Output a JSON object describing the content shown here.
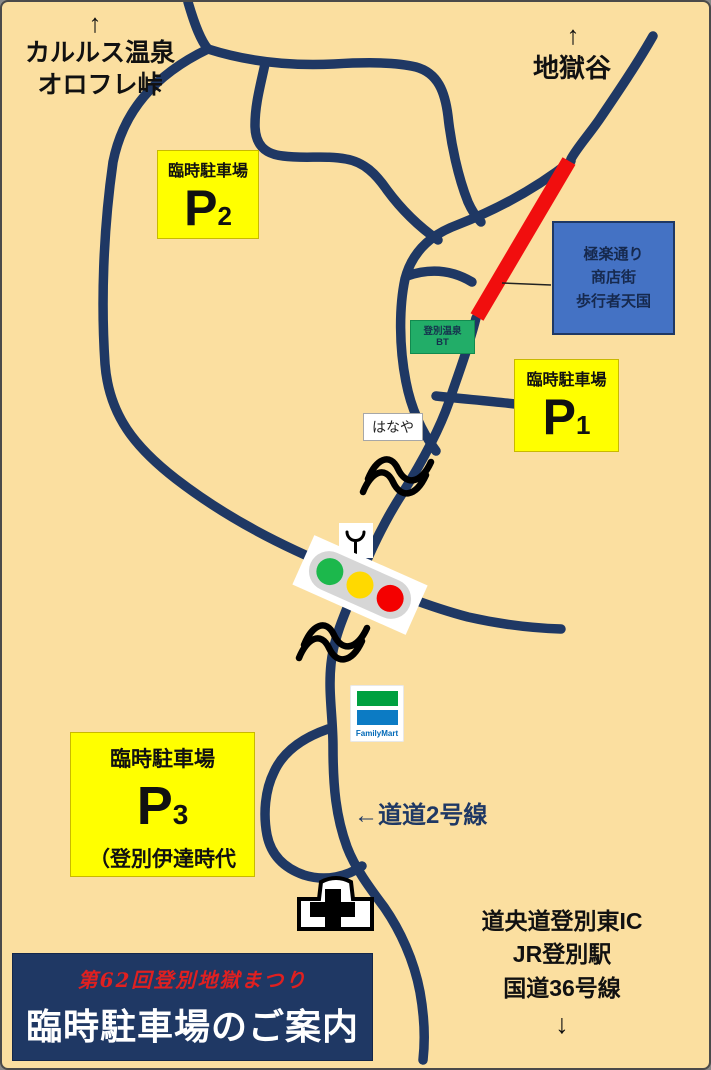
{
  "colors": {
    "background": "#FBDFA0",
    "road": "#1F3864",
    "pedestrian_red": "#F10E0E",
    "parking_yellow": "#FFFF00",
    "info_blue": "#4472C4",
    "bus_terminal_green": "#22AD68",
    "banner_navy": "#1F3864",
    "banner_red_text": "#E02020",
    "familymart_green": "#00A040",
    "familymart_blue": "#0C7BC4",
    "signal_green": "#1CB84C",
    "signal_yellow": "#FFD900",
    "signal_red": "#F40000"
  },
  "labels": {
    "top_left_arrow": "↑",
    "top_left_line1": "カルルス温泉",
    "top_left_line2": "オロフレ峠",
    "top_right_arrow": "↑",
    "top_right": "地獄谷",
    "road2": "←道道2号線",
    "south_line1": "道央道登別東IC",
    "south_line2": "JR登別駅",
    "south_line3": "国道36号線",
    "south_arrow": "↓"
  },
  "parking": {
    "p2": {
      "title": "臨時駐車場",
      "letter": "P",
      "number": "2"
    },
    "p1": {
      "title": "臨時駐車場",
      "letter": "P",
      "number": "1"
    },
    "p3": {
      "title": "臨時駐車場",
      "letter": "P",
      "number": "3",
      "note": "（登別伊達時代"
    }
  },
  "pedestrian_zone": {
    "line1": "極楽通り",
    "line2": "商店街",
    "line3": "歩行者天国"
  },
  "bus_terminal": {
    "line1": "登別温泉",
    "line2": "BT"
  },
  "shops": {
    "hanaya": "はなや",
    "familymart": "FamilyMart"
  },
  "banner": {
    "subtitle": "第62回登別地獄まつり",
    "title": "臨時駐車場のご案内"
  }
}
